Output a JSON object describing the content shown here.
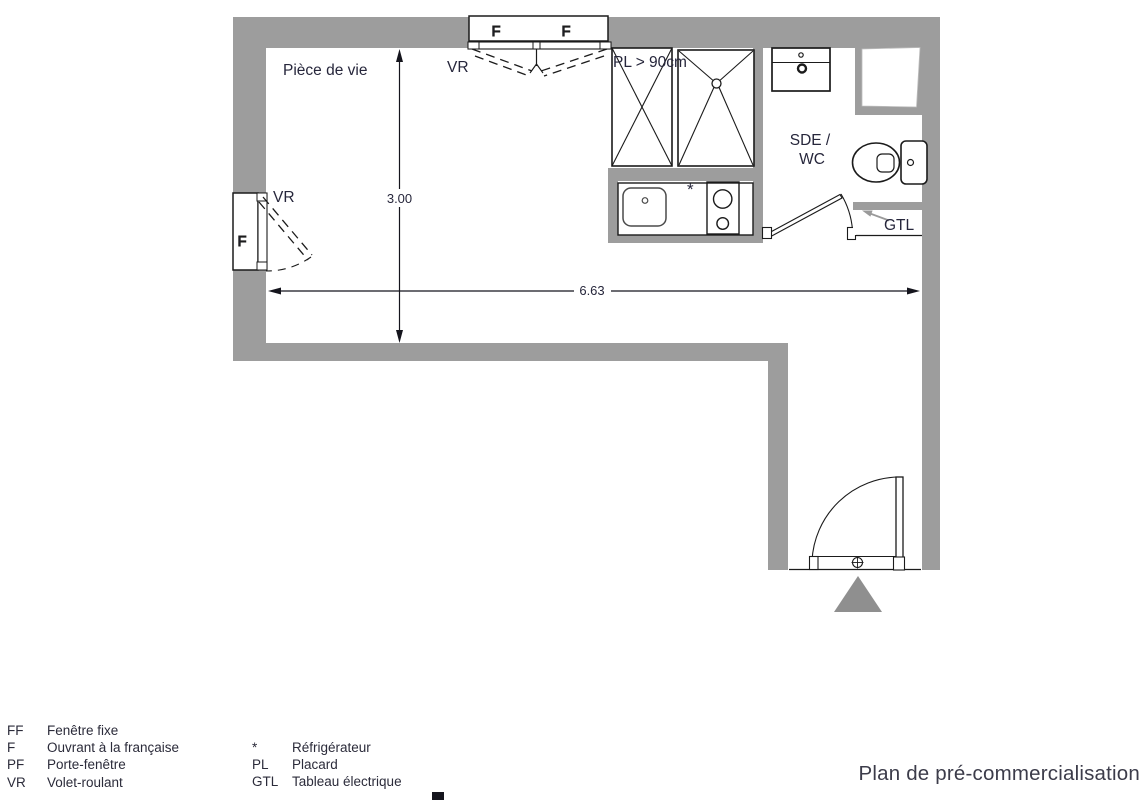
{
  "title": "Plan de pré-commercialisation",
  "plan": {
    "room_label": "Pièce de vie",
    "dim_height": "3.00",
    "dim_width": "6.63",
    "top_window": {
      "f_left": "F",
      "f_right": "F",
      "vr": "VR"
    },
    "left_window": {
      "f": "F",
      "vr": "VR"
    },
    "closet_label": "PL > 90cm",
    "fridge_marker": "*",
    "bathroom_line1": "SDE /",
    "bathroom_line2": "WC",
    "gtl_label": "GTL"
  },
  "legend": {
    "col1": [
      {
        "key": "FF",
        "label": "Fenêtre fixe"
      },
      {
        "key": "F",
        "label": "Ouvrant à la française"
      },
      {
        "key": "PF",
        "label": "Porte-fenêtre"
      },
      {
        "key": "VR",
        "label": "Volet-roulant"
      }
    ],
    "col2": [
      {
        "key": "*",
        "label": "Réfrigérateur"
      },
      {
        "key": "PL",
        "label": "Placard"
      },
      {
        "key": "GTL",
        "label": "Tableau électrique"
      }
    ]
  },
  "colors": {
    "wall_gray": "#9d9d9d",
    "entry_triangle_gray": "#8f8f8f",
    "line_black": "#1b1b1b",
    "text_ink": "#26263b"
  }
}
